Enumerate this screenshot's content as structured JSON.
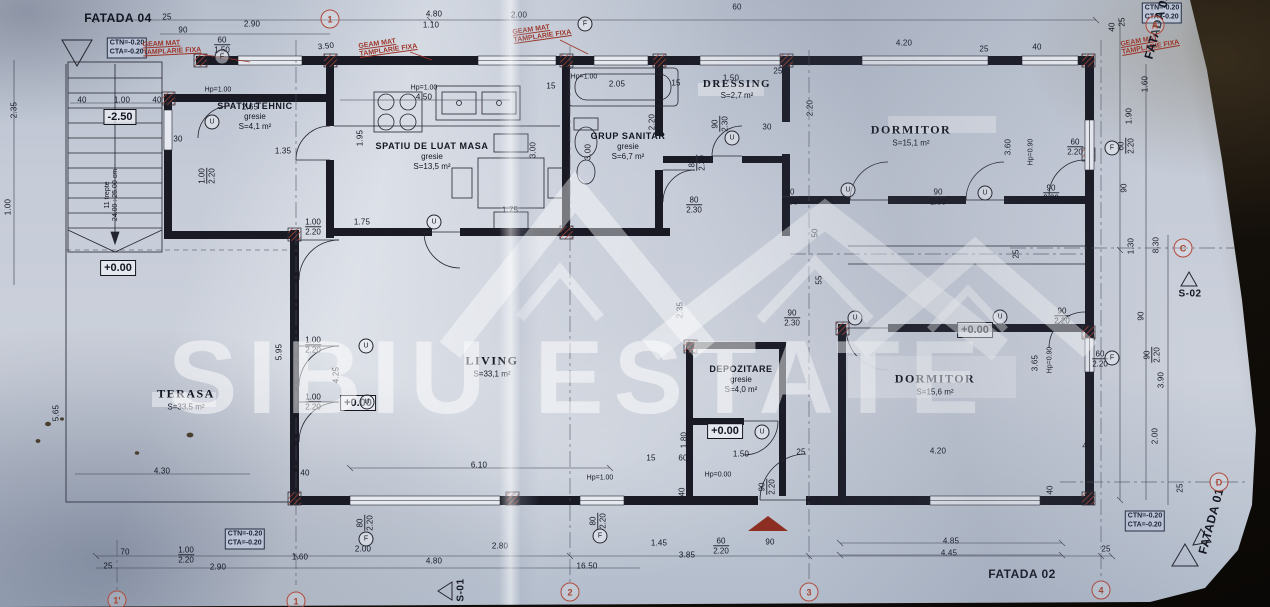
{
  "watermark": {
    "text": "SIBIU ESTATE"
  },
  "rooms": [
    {
      "name": "SPATIU TEHNIC",
      "finish": "gresie",
      "area": "S=4,1 m²",
      "x": 255,
      "y": 116,
      "s": 9,
      "serif": false
    },
    {
      "name": "SPATIU DE LUAT MASA",
      "finish": "gresie",
      "area": "S=13,5 m²",
      "x": 432,
      "y": 156,
      "s": 9,
      "serif": false
    },
    {
      "name": "GRUP SANITAR",
      "finish": "gresie",
      "area": "S=6,7 m²",
      "x": 628,
      "y": 146,
      "s": 9,
      "serif": false
    },
    {
      "name": "DRESSING",
      "finish": "",
      "area": "S=2,7 m²",
      "x": 737,
      "y": 89,
      "s": 11,
      "serif": true
    },
    {
      "name": "DORMITOR",
      "finish": "",
      "area": "S=15,1 m²",
      "x": 911,
      "y": 135,
      "s": 12,
      "serif": true
    },
    {
      "name": "LIVING",
      "finish": "",
      "area": "S=33,1 m²",
      "x": 492,
      "y": 366,
      "s": 12,
      "serif": true
    },
    {
      "name": "DEPOZITARE",
      "finish": "gresie",
      "area": "S=4,0 m²",
      "x": 741,
      "y": 379,
      "s": 9,
      "serif": false
    },
    {
      "name": "DORMITOR",
      "finish": "",
      "area": "S=15,6 m²",
      "x": 935,
      "y": 384,
      "s": 12,
      "serif": true
    },
    {
      "name": "TERASA",
      "finish": "",
      "area": "S=33,5 m²",
      "x": 186,
      "y": 399,
      "s": 12,
      "serif": true
    }
  ],
  "elevations": [
    {
      "t": "-2.50",
      "x": 120,
      "y": 117
    },
    {
      "t": "+0.00",
      "x": 118,
      "y": 268
    },
    {
      "t": "+0.00",
      "x": 358,
      "y": 403
    },
    {
      "t": "+0.00",
      "x": 725,
      "y": 431
    },
    {
      "t": "+0.00",
      "x": 975,
      "y": 330
    }
  ],
  "corner_notes": [
    {
      "l1": "CTN=-0.20",
      "l2": "CTA=-0.20",
      "x": 127,
      "y": 48
    },
    {
      "l1": "CTN=-0.20",
      "l2": "CTA=-0.20",
      "x": 1162,
      "y": 13
    },
    {
      "l1": "CTN=-0.20",
      "l2": "CTA=-0.20",
      "x": 245,
      "y": 539
    },
    {
      "l1": "CTN=-0.20",
      "l2": "CTA=-0.20",
      "x": 1145,
      "y": 521
    }
  ],
  "window_notes": [
    {
      "l1": "GEAM MAT",
      "l2": "TAMPLARIE FIXA",
      "x": 172,
      "y": 48,
      "r": -3
    },
    {
      "l1": "GEAM MAT",
      "l2": "TAMPLARIE FIXA",
      "x": 388,
      "y": 47,
      "r": -8
    },
    {
      "l1": "GEAM MAT",
      "l2": "TAMPLARIE FIXA",
      "x": 542,
      "y": 33,
      "r": -8
    },
    {
      "l1": "GEAM MAT",
      "l2": "TAMPLARIE FIXA",
      "x": 1150,
      "y": 44,
      "r": -10
    }
  ],
  "facades": [
    {
      "t": "FATADA 04",
      "x": 118,
      "y": 18,
      "r": 0
    },
    {
      "t": "FATADA 02",
      "x": 1022,
      "y": 574,
      "r": 0
    },
    {
      "t": "FATADA 01",
      "x": 1211,
      "y": 521,
      "r": -75
    },
    {
      "t": "FATADA 03",
      "x": 1157,
      "y": 26,
      "r": -75
    }
  ],
  "sections": [
    {
      "t": "S-01",
      "x": 461,
      "y": 590,
      "r": -90
    },
    {
      "t": "S-02",
      "x": 1190,
      "y": 294,
      "r": 0
    }
  ],
  "grid_bubbles": [
    {
      "t": "1'",
      "x": 117,
      "y": 600
    },
    {
      "t": "1",
      "x": 296,
      "y": 601
    },
    {
      "t": "2",
      "x": 570,
      "y": 592
    },
    {
      "t": "3",
      "x": 809,
      "y": 592
    },
    {
      "t": "4",
      "x": 1101,
      "y": 590
    },
    {
      "t": "1",
      "x": 330,
      "y": 19
    },
    {
      "t": "A",
      "x": 1155,
      "y": 25
    },
    {
      "t": "C",
      "x": 1183,
      "y": 248
    },
    {
      "t": "D",
      "x": 1219,
      "y": 482
    }
  ],
  "marks": [
    {
      "t": "U",
      "x": 212,
      "y": 122
    },
    {
      "t": "U",
      "x": 434,
      "y": 222
    },
    {
      "t": "U",
      "x": 366,
      "y": 346
    },
    {
      "t": "U",
      "x": 367,
      "y": 402
    },
    {
      "t": "U",
      "x": 732,
      "y": 138
    },
    {
      "t": "U",
      "x": 848,
      "y": 190
    },
    {
      "t": "U",
      "x": 985,
      "y": 193
    },
    {
      "t": "U",
      "x": 855,
      "y": 318
    },
    {
      "t": "U",
      "x": 1000,
      "y": 317
    },
    {
      "t": "U",
      "x": 762,
      "y": 432
    },
    {
      "t": "F",
      "x": 222,
      "y": 57
    },
    {
      "t": "F",
      "x": 585,
      "y": 24
    },
    {
      "t": "F",
      "x": 366,
      "y": 539
    },
    {
      "t": "F",
      "x": 600,
      "y": 536
    },
    {
      "t": "F",
      "x": 1112,
      "y": 148
    },
    {
      "t": "F",
      "x": 1112,
      "y": 358
    }
  ],
  "stair_note": {
    "l1": "11 trepte",
    "l2": "24.00 : 25.00 cm",
    "x": 112,
    "y": 195
  },
  "dims": [
    {
      "t": "25",
      "x": 167,
      "y": 17
    },
    {
      "t": "90",
      "x": 183,
      "y": 30
    },
    {
      "t": "2.90",
      "x": 252,
      "y": 24
    },
    {
      "t": "3.50",
      "x": 326,
      "y": 46,
      "r": -6
    },
    {
      "t": "4.80",
      "x": 434,
      "y": 14
    },
    {
      "t": "1.10",
      "x": 431,
      "y": 25
    },
    {
      "t": "2.00",
      "x": 519,
      "y": 15
    },
    {
      "t": "60",
      "x": 737,
      "y": 7
    },
    {
      "t": "4.20",
      "x": 904,
      "y": 43
    },
    {
      "t": "25",
      "x": 984,
      "y": 49
    },
    {
      "t": "40",
      "x": 1037,
      "y": 47
    },
    {
      "t": "40",
      "x": 82,
      "y": 100
    },
    {
      "t": "1.00",
      "x": 122,
      "y": 100
    },
    {
      "t": "40",
      "x": 157,
      "y": 100
    },
    {
      "t": "Hp=1.00",
      "x": 218,
      "y": 90
    },
    {
      "t": "2.65",
      "x": 250,
      "y": 107
    },
    {
      "t": "30",
      "x": 178,
      "y": 139
    },
    {
      "t": "1.35",
      "x": 283,
      "y": 151
    },
    {
      "t": "Hp=1.00",
      "x": 424,
      "y": 88
    },
    {
      "t": "4.50",
      "x": 424,
      "y": 97
    },
    {
      "t": "1.95",
      "x": 360,
      "y": 138,
      "r": -90
    },
    {
      "t": "15",
      "x": 551,
      "y": 86
    },
    {
      "t": "Hp=1.00",
      "x": 584,
      "y": 77
    },
    {
      "t": "2.05",
      "x": 617,
      "y": 84
    },
    {
      "t": "3.00",
      "x": 533,
      "y": 150,
      "r": -90
    },
    {
      "t": "3.00",
      "x": 588,
      "y": 152,
      "r": -90
    },
    {
      "t": "15",
      "x": 676,
      "y": 83
    },
    {
      "t": "1.50",
      "x": 731,
      "y": 78
    },
    {
      "t": "25",
      "x": 778,
      "y": 71
    },
    {
      "t": "30",
      "x": 767,
      "y": 127
    },
    {
      "t": "2.20",
      "x": 810,
      "y": 108,
      "r": -90
    },
    {
      "t": "2.20",
      "x": 652,
      "y": 122,
      "r": -90
    },
    {
      "t": "3.60",
      "x": 1008,
      "y": 147,
      "r": -90
    },
    {
      "t": "Hp=0.90",
      "x": 1031,
      "y": 152,
      "r": -90
    },
    {
      "t": "90",
      "x": 1124,
      "y": 188,
      "r": -90
    },
    {
      "t": "1.90",
      "x": 1129,
      "y": 116,
      "r": -90
    },
    {
      "t": "1.60",
      "x": 1145,
      "y": 84,
      "r": -90
    },
    {
      "t": "40",
      "x": 1112,
      "y": 27,
      "r": -90
    },
    {
      "t": "25",
      "x": 1122,
      "y": 22,
      "r": -90
    },
    {
      "t": "1.75",
      "x": 362,
      "y": 222
    },
    {
      "t": "1.75",
      "x": 510,
      "y": 210
    },
    {
      "t": "2.35",
      "x": 680,
      "y": 310,
      "r": -90
    },
    {
      "t": "50",
      "x": 815,
      "y": 233,
      "r": -90
    },
    {
      "t": "55",
      "x": 819,
      "y": 280,
      "r": -90
    },
    {
      "t": "25",
      "x": 1016,
      "y": 254,
      "r": -90
    },
    {
      "t": "1.30",
      "x": 1131,
      "y": 246,
      "r": -90
    },
    {
      "t": "8.30",
      "x": 1156,
      "y": 245,
      "r": -90
    },
    {
      "t": "2.35",
      "x": 14,
      "y": 110,
      "r": -90
    },
    {
      "t": "1.00",
      "x": 8,
      "y": 207,
      "r": -90
    },
    {
      "t": "5.65",
      "x": 56,
      "y": 413,
      "r": -90
    },
    {
      "t": "5.95",
      "x": 279,
      "y": 352,
      "r": -90
    },
    {
      "t": "4.25",
      "x": 336,
      "y": 375,
      "r": -90
    },
    {
      "t": "4.30",
      "x": 162,
      "y": 471
    },
    {
      "t": "40",
      "x": 305,
      "y": 473
    },
    {
      "t": "6.10",
      "x": 479,
      "y": 465
    },
    {
      "t": "15",
      "x": 651,
      "y": 458
    },
    {
      "t": "60",
      "x": 683,
      "y": 458
    },
    {
      "t": "1.50",
      "x": 741,
      "y": 454
    },
    {
      "t": "25",
      "x": 801,
      "y": 452
    },
    {
      "t": "1.80",
      "x": 684,
      "y": 440,
      "r": -90
    },
    {
      "t": "40",
      "x": 682,
      "y": 492,
      "r": -90
    },
    {
      "t": "Hp=1.00",
      "x": 600,
      "y": 478
    },
    {
      "t": "Hp=0.00",
      "x": 718,
      "y": 475
    },
    {
      "t": "3.65",
      "x": 1035,
      "y": 363,
      "r": -90
    },
    {
      "t": "Hp=0.90",
      "x": 1050,
      "y": 360,
      "r": -90
    },
    {
      "t": "3.90",
      "x": 1161,
      "y": 380,
      "r": -90
    },
    {
      "t": "90",
      "x": 1141,
      "y": 316,
      "r": -90
    },
    {
      "t": "2.00",
      "x": 1155,
      "y": 436,
      "r": -90
    },
    {
      "t": "25",
      "x": 1180,
      "y": 488,
      "r": -90
    },
    {
      "t": "40",
      "x": 1087,
      "y": 446
    },
    {
      "t": "40",
      "x": 1050,
      "y": 490,
      "r": -90
    },
    {
      "t": "4.20",
      "x": 938,
      "y": 451
    },
    {
      "t": "4.85",
      "x": 951,
      "y": 541
    },
    {
      "t": "4.45",
      "x": 949,
      "y": 553
    },
    {
      "t": "25",
      "x": 1106,
      "y": 549
    },
    {
      "t": "25",
      "x": 108,
      "y": 566
    },
    {
      "t": "70",
      "x": 125,
      "y": 552
    },
    {
      "t": "1.60",
      "x": 300,
      "y": 557
    },
    {
      "t": "2.90",
      "x": 218,
      "y": 567
    },
    {
      "t": "2.00",
      "x": 363,
      "y": 549
    },
    {
      "t": "4.80",
      "x": 434,
      "y": 561
    },
    {
      "t": "2.80",
      "x": 500,
      "y": 546
    },
    {
      "t": "16.50",
      "x": 587,
      "y": 566
    },
    {
      "t": "1.45",
      "x": 659,
      "y": 543
    },
    {
      "t": "3.85",
      "x": 687,
      "y": 555
    },
    {
      "t": "90",
      "x": 770,
      "y": 542
    }
  ],
  "fracs": [
    {
      "a": "60",
      "b": "1.50",
      "x": 222,
      "y": 45
    },
    {
      "a": "1.00",
      "b": "2.20",
      "x": 207,
      "y": 176,
      "r": -90
    },
    {
      "a": "90",
      "b": "2.30",
      "x": 720,
      "y": 124,
      "r": -90
    },
    {
      "a": "80",
      "b": "2.30",
      "x": 697,
      "y": 163,
      "r": -90
    },
    {
      "a": "80",
      "b": "2.30",
      "x": 694,
      "y": 205
    },
    {
      "a": "90",
      "b": "2.30",
      "x": 790,
      "y": 197
    },
    {
      "a": "90",
      "b": "2.30",
      "x": 938,
      "y": 197
    },
    {
      "a": "90",
      "b": "2.20",
      "x": 1051,
      "y": 193
    },
    {
      "a": "90",
      "b": "2.30",
      "x": 792,
      "y": 318
    },
    {
      "a": "90",
      "b": "2.20",
      "x": 1062,
      "y": 316
    },
    {
      "a": "60",
      "b": "2.20",
      "x": 1100,
      "y": 359
    },
    {
      "a": "60",
      "b": "2.20",
      "x": 1126,
      "y": 146,
      "r": -90
    },
    {
      "a": "60",
      "b": "2.20",
      "x": 1075,
      "y": 147
    },
    {
      "a": "1.00",
      "b": "2.20",
      "x": 313,
      "y": 227
    },
    {
      "a": "1.00",
      "b": "2.20",
      "x": 313,
      "y": 345
    },
    {
      "a": "1.00",
      "b": "2.20",
      "x": 313,
      "y": 402
    },
    {
      "a": "90",
      "b": "2.20",
      "x": 767,
      "y": 487,
      "r": -90
    },
    {
      "a": "80",
      "b": "2.20",
      "x": 365,
      "y": 523,
      "r": -90
    },
    {
      "a": "80",
      "b": "2.20",
      "x": 598,
      "y": 521,
      "r": -90
    },
    {
      "a": "60",
      "b": "2.20",
      "x": 721,
      "y": 546
    },
    {
      "a": "1.00",
      "b": "2.20",
      "x": 186,
      "y": 555
    },
    {
      "a": "90",
      "b": "2.20",
      "x": 1152,
      "y": 355,
      "r": -90
    }
  ]
}
